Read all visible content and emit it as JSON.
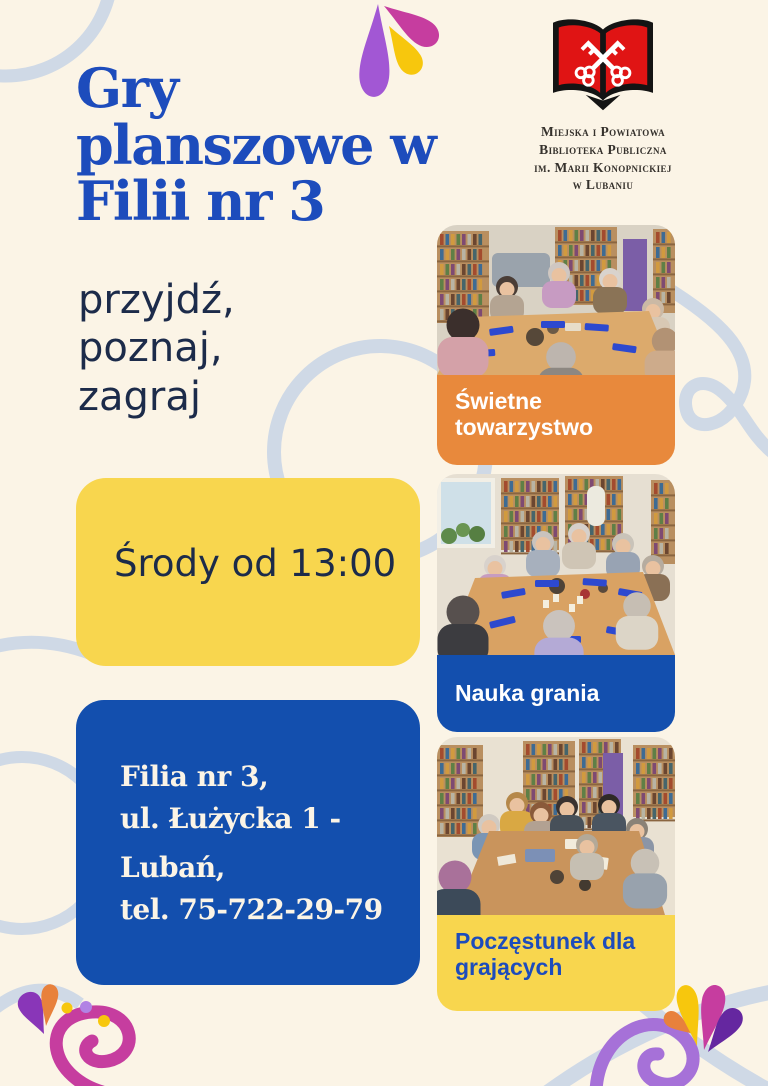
{
  "title": "Gry planszowe w Filii nr 3",
  "logo": {
    "icon": "open-book-with-crossed-keys",
    "org_lines": [
      "Miejska i Powiatowa",
      "Biblioteka Publiczna",
      "im. Marii Konopnickiej",
      "w Lubaniu"
    ]
  },
  "tagline": {
    "lines": [
      "przyjdź,",
      "poznaj,",
      "zagraj"
    ]
  },
  "schedule": {
    "text": "Środy od 13:00",
    "bg": "#f8d64e"
  },
  "contact": {
    "bg": "#134fae",
    "lines": [
      "Filia nr 3,",
      "ul. Łużycka 1 -",
      "Lubań,",
      "tel. 75-722-29-79"
    ]
  },
  "cards": [
    {
      "caption": "Świetne towarzystwo",
      "bg": "#e8893c",
      "fg": "#ffffff"
    },
    {
      "caption": "Nauka grania",
      "bg": "#134fae",
      "fg": "#ffffff"
    },
    {
      "caption": "Poczęstunek dla grających",
      "bg": "#f8d64e",
      "fg": "#1d4cbc"
    }
  ],
  "palette": {
    "background": "#fbf4e6",
    "title_blue": "#1d4cbc",
    "navy_text": "#1c2b4a",
    "logo_red": "#e01414",
    "decor_ring": "#cfd9e6",
    "splash_purple": "#a257d4",
    "splash_magenta": "#c63d9f",
    "splash_yellow": "#f7c70d",
    "splash_orange": "#e8813c",
    "splash_dark_purple": "#6527a0"
  }
}
